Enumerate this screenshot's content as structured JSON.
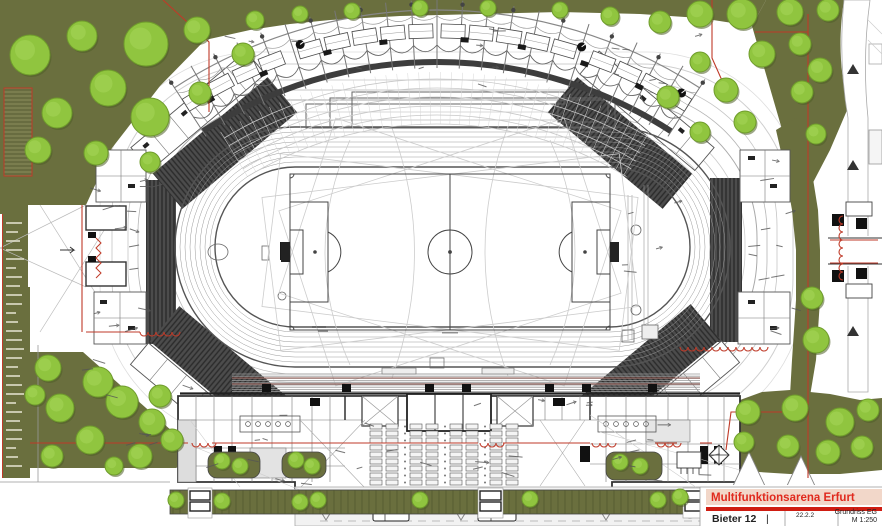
{
  "title_block": {
    "project_title": "Multifunktionsarena Erfurt",
    "bidder_label": "Bieter 12",
    "separator": "|",
    "date_code": "22.2.2",
    "drawing_name": "Grundriss EG",
    "scale_label": "M 1:250"
  },
  "colors": {
    "olive": "#6a6f3e",
    "olive_dark": "#51562f",
    "olive_light": "#7a7d4e",
    "tree_fill": "#90c53f",
    "tree_stroke": "#6f9c2c",
    "tree_shadow": "#4e5e27",
    "tree_highlight": "#a8d75c",
    "boundary_red": "#bf3a28",
    "title_red": "#e02a1e",
    "title_band": "#f2d7c9",
    "bar_red": "#cf1d12",
    "stand_dark": "#454545",
    "line_dark": "#444444",
    "line_mid": "#888888",
    "line_light": "#cccccc",
    "seat_red": "#8a5048"
  },
  "decor": {
    "trees": [
      [
        30,
        55,
        20
      ],
      [
        82,
        36,
        15
      ],
      [
        146,
        44,
        22
      ],
      [
        197,
        30,
        13
      ],
      [
        243,
        54,
        11
      ],
      [
        108,
        88,
        18
      ],
      [
        57,
        113,
        15
      ],
      [
        150,
        117,
        19
      ],
      [
        200,
        93,
        11
      ],
      [
        38,
        150,
        13
      ],
      [
        96,
        153,
        12
      ],
      [
        150,
        162,
        10
      ],
      [
        255,
        20,
        9
      ],
      [
        300,
        14,
        8
      ],
      [
        352,
        11,
        8
      ],
      [
        420,
        8,
        8
      ],
      [
        488,
        8,
        8
      ],
      [
        560,
        10,
        8
      ],
      [
        610,
        16,
        9
      ],
      [
        660,
        22,
        11
      ],
      [
        700,
        14,
        13
      ],
      [
        742,
        14,
        15
      ],
      [
        762,
        54,
        13
      ],
      [
        726,
        90,
        12
      ],
      [
        700,
        62,
        10
      ],
      [
        668,
        97,
        11
      ],
      [
        700,
        132,
        10
      ],
      [
        745,
        122,
        11
      ],
      [
        790,
        12,
        13
      ],
      [
        828,
        10,
        11
      ],
      [
        800,
        44,
        11
      ],
      [
        820,
        70,
        12
      ],
      [
        802,
        92,
        11
      ],
      [
        816,
        134,
        10
      ],
      [
        812,
        298,
        11
      ],
      [
        816,
        340,
        13
      ],
      [
        748,
        412,
        12
      ],
      [
        795,
        408,
        13
      ],
      [
        840,
        422,
        14
      ],
      [
        868,
        410,
        11
      ],
      [
        788,
        446,
        11
      ],
      [
        828,
        452,
        12
      ],
      [
        862,
        447,
        11
      ],
      [
        744,
        442,
        10
      ],
      [
        48,
        368,
        13
      ],
      [
        98,
        382,
        15
      ],
      [
        60,
        408,
        14
      ],
      [
        122,
        402,
        16
      ],
      [
        152,
        422,
        13
      ],
      [
        90,
        440,
        14
      ],
      [
        52,
        456,
        11
      ],
      [
        140,
        456,
        12
      ],
      [
        172,
        440,
        11
      ],
      [
        114,
        466,
        9
      ],
      [
        35,
        395,
        10
      ],
      [
        160,
        396,
        11
      ],
      [
        222,
        461,
        8
      ],
      [
        240,
        466,
        8
      ],
      [
        296,
        460,
        8
      ],
      [
        312,
        466,
        8
      ],
      [
        620,
        462,
        8
      ],
      [
        640,
        466,
        8
      ],
      [
        176,
        500,
        8
      ],
      [
        222,
        501,
        8
      ],
      [
        300,
        502,
        8
      ],
      [
        318,
        500,
        8
      ],
      [
        420,
        500,
        8
      ],
      [
        530,
        499,
        8
      ],
      [
        658,
        500,
        8
      ],
      [
        680,
        497,
        8
      ]
    ],
    "canopy": {
      "cx": 437,
      "cy": 492,
      "r_outer": 482,
      "r_scallop": 447,
      "r_scallop2": 476,
      "r_dark": 430,
      "r_rooms": 461,
      "deg_min": -33,
      "deg_max": 33,
      "mast_step": 3,
      "concourse_radii": [
        368,
        377,
        386,
        395,
        404,
        413
      ],
      "room_angles": [
        -31.5,
        -28,
        -24.5,
        -21,
        -16,
        -12.5,
        -9,
        -5.5,
        -2,
        2,
        5.5,
        9,
        12.5,
        16,
        21,
        24.5,
        28,
        31.5
      ],
      "black_room_angles": [
        -30,
        -22.5,
        -14,
        -6.8,
        3.5,
        10.8,
        19,
        26.5,
        30.5
      ],
      "fan_angles": [
        -17,
        18,
        -30.5,
        31.5
      ]
    },
    "track": {
      "x": 175,
      "y": 127,
      "w": 555,
      "h": 240,
      "lanes": 8,
      "step": 5
    },
    "south_stand": {
      "x1": 232,
      "x2": 700,
      "y_top": 374,
      "rows": 9,
      "row_dy": 2.2,
      "red_rows": [
        378,
        384
      ],
      "vomitories": [
        262,
        342,
        425,
        462,
        545,
        582,
        648
      ]
    },
    "tables": {
      "x0": 370,
      "y0": 424,
      "groups": 4,
      "group_dx": 40,
      "cols": 2,
      "col_dx": 16,
      "rows": 9,
      "row_dy": 7,
      "w": 12,
      "h": 5
    },
    "parking": {
      "x1": 170,
      "x2": 740,
      "y1": 490,
      "y2": 514,
      "hatch_step": 7,
      "gaps": [
        [
          188,
          212
        ],
        [
          478,
          503
        ],
        [
          683,
          703
        ]
      ]
    },
    "left_strip": {
      "x": 2,
      "w": 28,
      "y1": 214,
      "y2": 478,
      "row_step": 9
    },
    "red_lines": [
      [
        [
          163,
          0
        ],
        [
          209,
          42
        ],
        [
          209,
          112
        ]
      ],
      [
        [
          712,
          0
        ],
        [
          712,
          58
        ],
        [
          728,
          94
        ]
      ],
      [
        [
          755,
          32
        ],
        [
          808,
          32
        ]
      ],
      [
        [
          808,
          14
        ],
        [
          808,
          478
        ]
      ],
      [
        [
          82,
          205
        ],
        [
          82,
          332
        ]
      ],
      [
        [
          86,
          332
        ],
        [
          140,
          332
        ]
      ],
      [
        [
          30,
          443
        ],
        [
          188,
          443
        ]
      ],
      [
        [
          212,
          443
        ],
        [
          478,
          443
        ]
      ],
      [
        [
          503,
          443
        ],
        [
          590,
          443
        ]
      ],
      [
        [
          655,
          443
        ],
        [
          677,
          443
        ]
      ],
      [
        [
          700,
          443
        ],
        [
          712,
          443
        ]
      ],
      [
        [
          726,
          450
        ],
        [
          731,
          412
        ],
        [
          808,
          412
        ]
      ],
      [
        [
          830,
          240
        ],
        [
          878,
          240
        ]
      ],
      [
        [
          830,
          263
        ],
        [
          878,
          263
        ]
      ]
    ],
    "red_scallops": [
      {
        "x": 140,
        "y": 332,
        "n": 5,
        "v": 0
      },
      {
        "x": 192,
        "y": 443,
        "n": 3,
        "v": 0
      },
      {
        "x": 480,
        "y": 443,
        "n": 3,
        "v": 0
      },
      {
        "x": 592,
        "y": 443,
        "n": 3,
        "v": 0
      },
      {
        "x": 657,
        "y": 443,
        "n": 3,
        "v": 0
      },
      {
        "x": 680,
        "y": 347,
        "n": 11,
        "v": 0
      },
      {
        "x": 843,
        "y": 216,
        "n": 8,
        "v": 1
      }
    ],
    "note_zones": [
      {
        "x": 88,
        "y": 175,
        "w": 70,
        "h": 180,
        "n": 14
      },
      {
        "x": 735,
        "y": 160,
        "w": 60,
        "h": 190,
        "n": 12
      },
      {
        "x": 200,
        "y": 28,
        "w": 500,
        "h": 60,
        "n": 16
      },
      {
        "x": 200,
        "y": 398,
        "w": 520,
        "h": 82,
        "n": 20
      },
      {
        "x": 55,
        "y": 358,
        "w": 130,
        "h": 110,
        "n": 8
      },
      {
        "x": 230,
        "y": 445,
        "w": 420,
        "h": 40,
        "n": 10
      },
      {
        "x": 620,
        "y": 180,
        "w": 60,
        "h": 150,
        "n": 6
      }
    ]
  }
}
